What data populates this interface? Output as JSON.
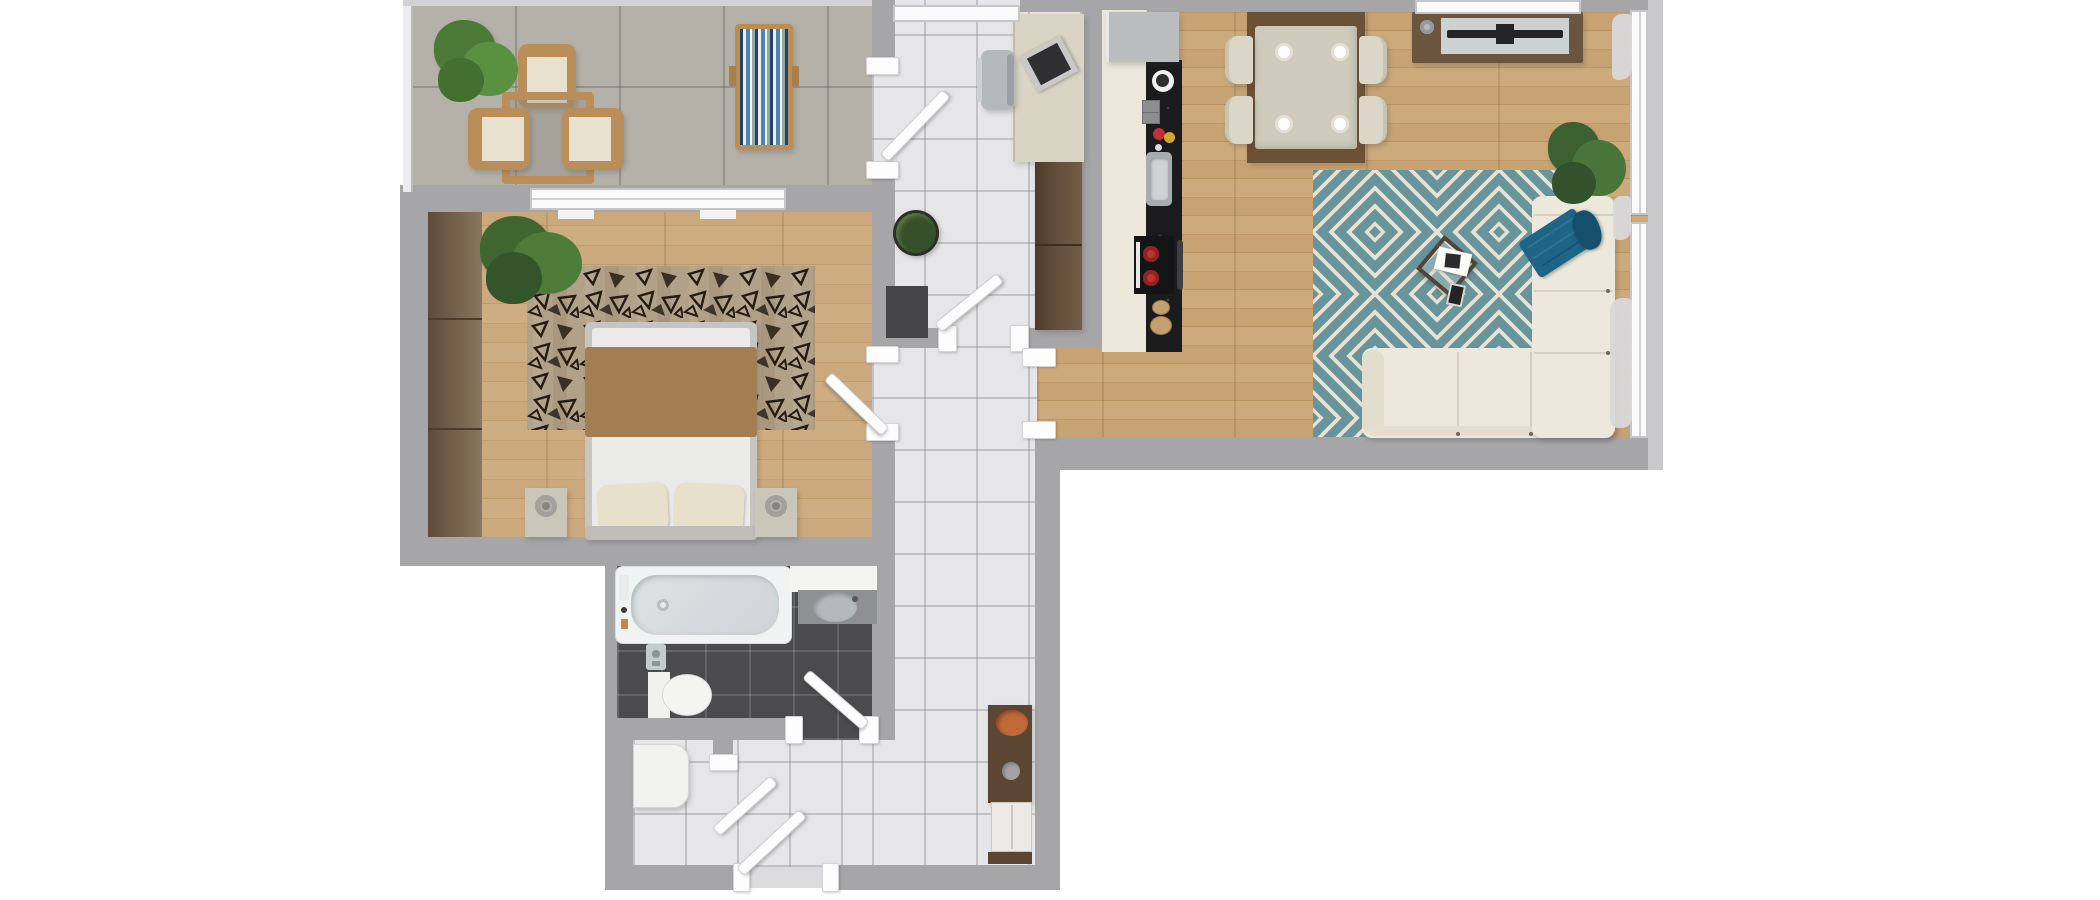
{
  "title": "3D apartment floor plan, top-down view",
  "floor_plan": {
    "type": "apartment-top-view-3d-render",
    "rooms": [
      {
        "name": "balcony",
        "floor": "concrete tile",
        "furniture": [
          "potted-plant",
          "bistro-table",
          "wood-chair",
          "wood-chair",
          "wood-chair",
          "sun-lounger"
        ]
      },
      {
        "name": "bedroom",
        "floor": "light oak",
        "furniture": [
          "wardrobe",
          "potted-plant",
          "patterned-area-rug",
          "double-bed",
          "brown-blanket",
          "pillow",
          "pillow",
          "nightstand",
          "nightstand",
          "table-lamp",
          "table-lamp",
          "window",
          "door"
        ]
      },
      {
        "name": "entry-hall",
        "floor": "white tile",
        "furniture": [
          "window",
          "desk",
          "laptop",
          "desk-chair",
          "tall-cabinet",
          "potted-plant",
          "doormat",
          "interior-door",
          "interior-door",
          "console-table",
          "decorative-bowl",
          "door-knob",
          "hall-bench"
        ]
      },
      {
        "name": "kitchen-living-dining",
        "floor": "light oak",
        "furniture": [
          "refrigerator",
          "kitchen-cabinets",
          "black-countertop",
          "paper-towel-holder",
          "spice-jars",
          "tomato",
          "lemon",
          "sink",
          "cooktop",
          "oven",
          "cutting-boards",
          "dining-table",
          "dining-chair",
          "dining-chair",
          "dining-chair",
          "dining-chair",
          "plate",
          "plate",
          "plate",
          "plate",
          "tv-stand",
          "tv",
          "speaker",
          "diamond-area-rug",
          "glass-coffee-table",
          "magazine",
          "smartphone",
          "corner-sofa",
          "throw-blanket",
          "navy-cushion",
          "potted-plant",
          "window-wall"
        ]
      },
      {
        "name": "bathroom",
        "floor": "dark gray tile",
        "furniture": [
          "bathtub",
          "bath-faucet",
          "vanity-counter",
          "washbasin",
          "toilet",
          "wall-taps",
          "door"
        ]
      },
      {
        "name": "laundry-storage",
        "floor": "white tile",
        "furniture": [
          "washing-machine",
          "interior-door",
          "entrance-door"
        ]
      }
    ]
  },
  "palette": {
    "white": "#ffffff",
    "wall": "#a6a6a9",
    "floor_tile": "#e6e6e8",
    "tile_grout": "#bdbdc1",
    "concrete": "#b4b1a9",
    "wood_light": "#cca97d",
    "wood_mid": "#c7a374",
    "wood_dark": "#6b5136",
    "wardrobe": "#6e5a44",
    "dark_tile": "#4b4b4d",
    "rug_bedroom_base": "#b2a189",
    "rug_ink": "#241c12",
    "rug_teal": "#67959b",
    "rug_cream": "#e9e2d2",
    "sofa_cream": "#ece8dc",
    "throw_teal": "#1e6486",
    "pillow_navy": "#14506e",
    "blanket_brown": "#a57d53",
    "pillow_cream": "#e7e0cb",
    "counter_black": "#1b1b1d",
    "cabinet_cream": "#ebe7da",
    "burner_red": "#c03230",
    "bowl_orange": "#c06a3a",
    "plant_green": "#4a7a35",
    "plant_dark": "#3c5e2c",
    "chair_wood": "#b98e58",
    "lounger_blue": "#4d84b4",
    "steel": "#a7acae",
    "tub_white": "#f1f3f3"
  }
}
